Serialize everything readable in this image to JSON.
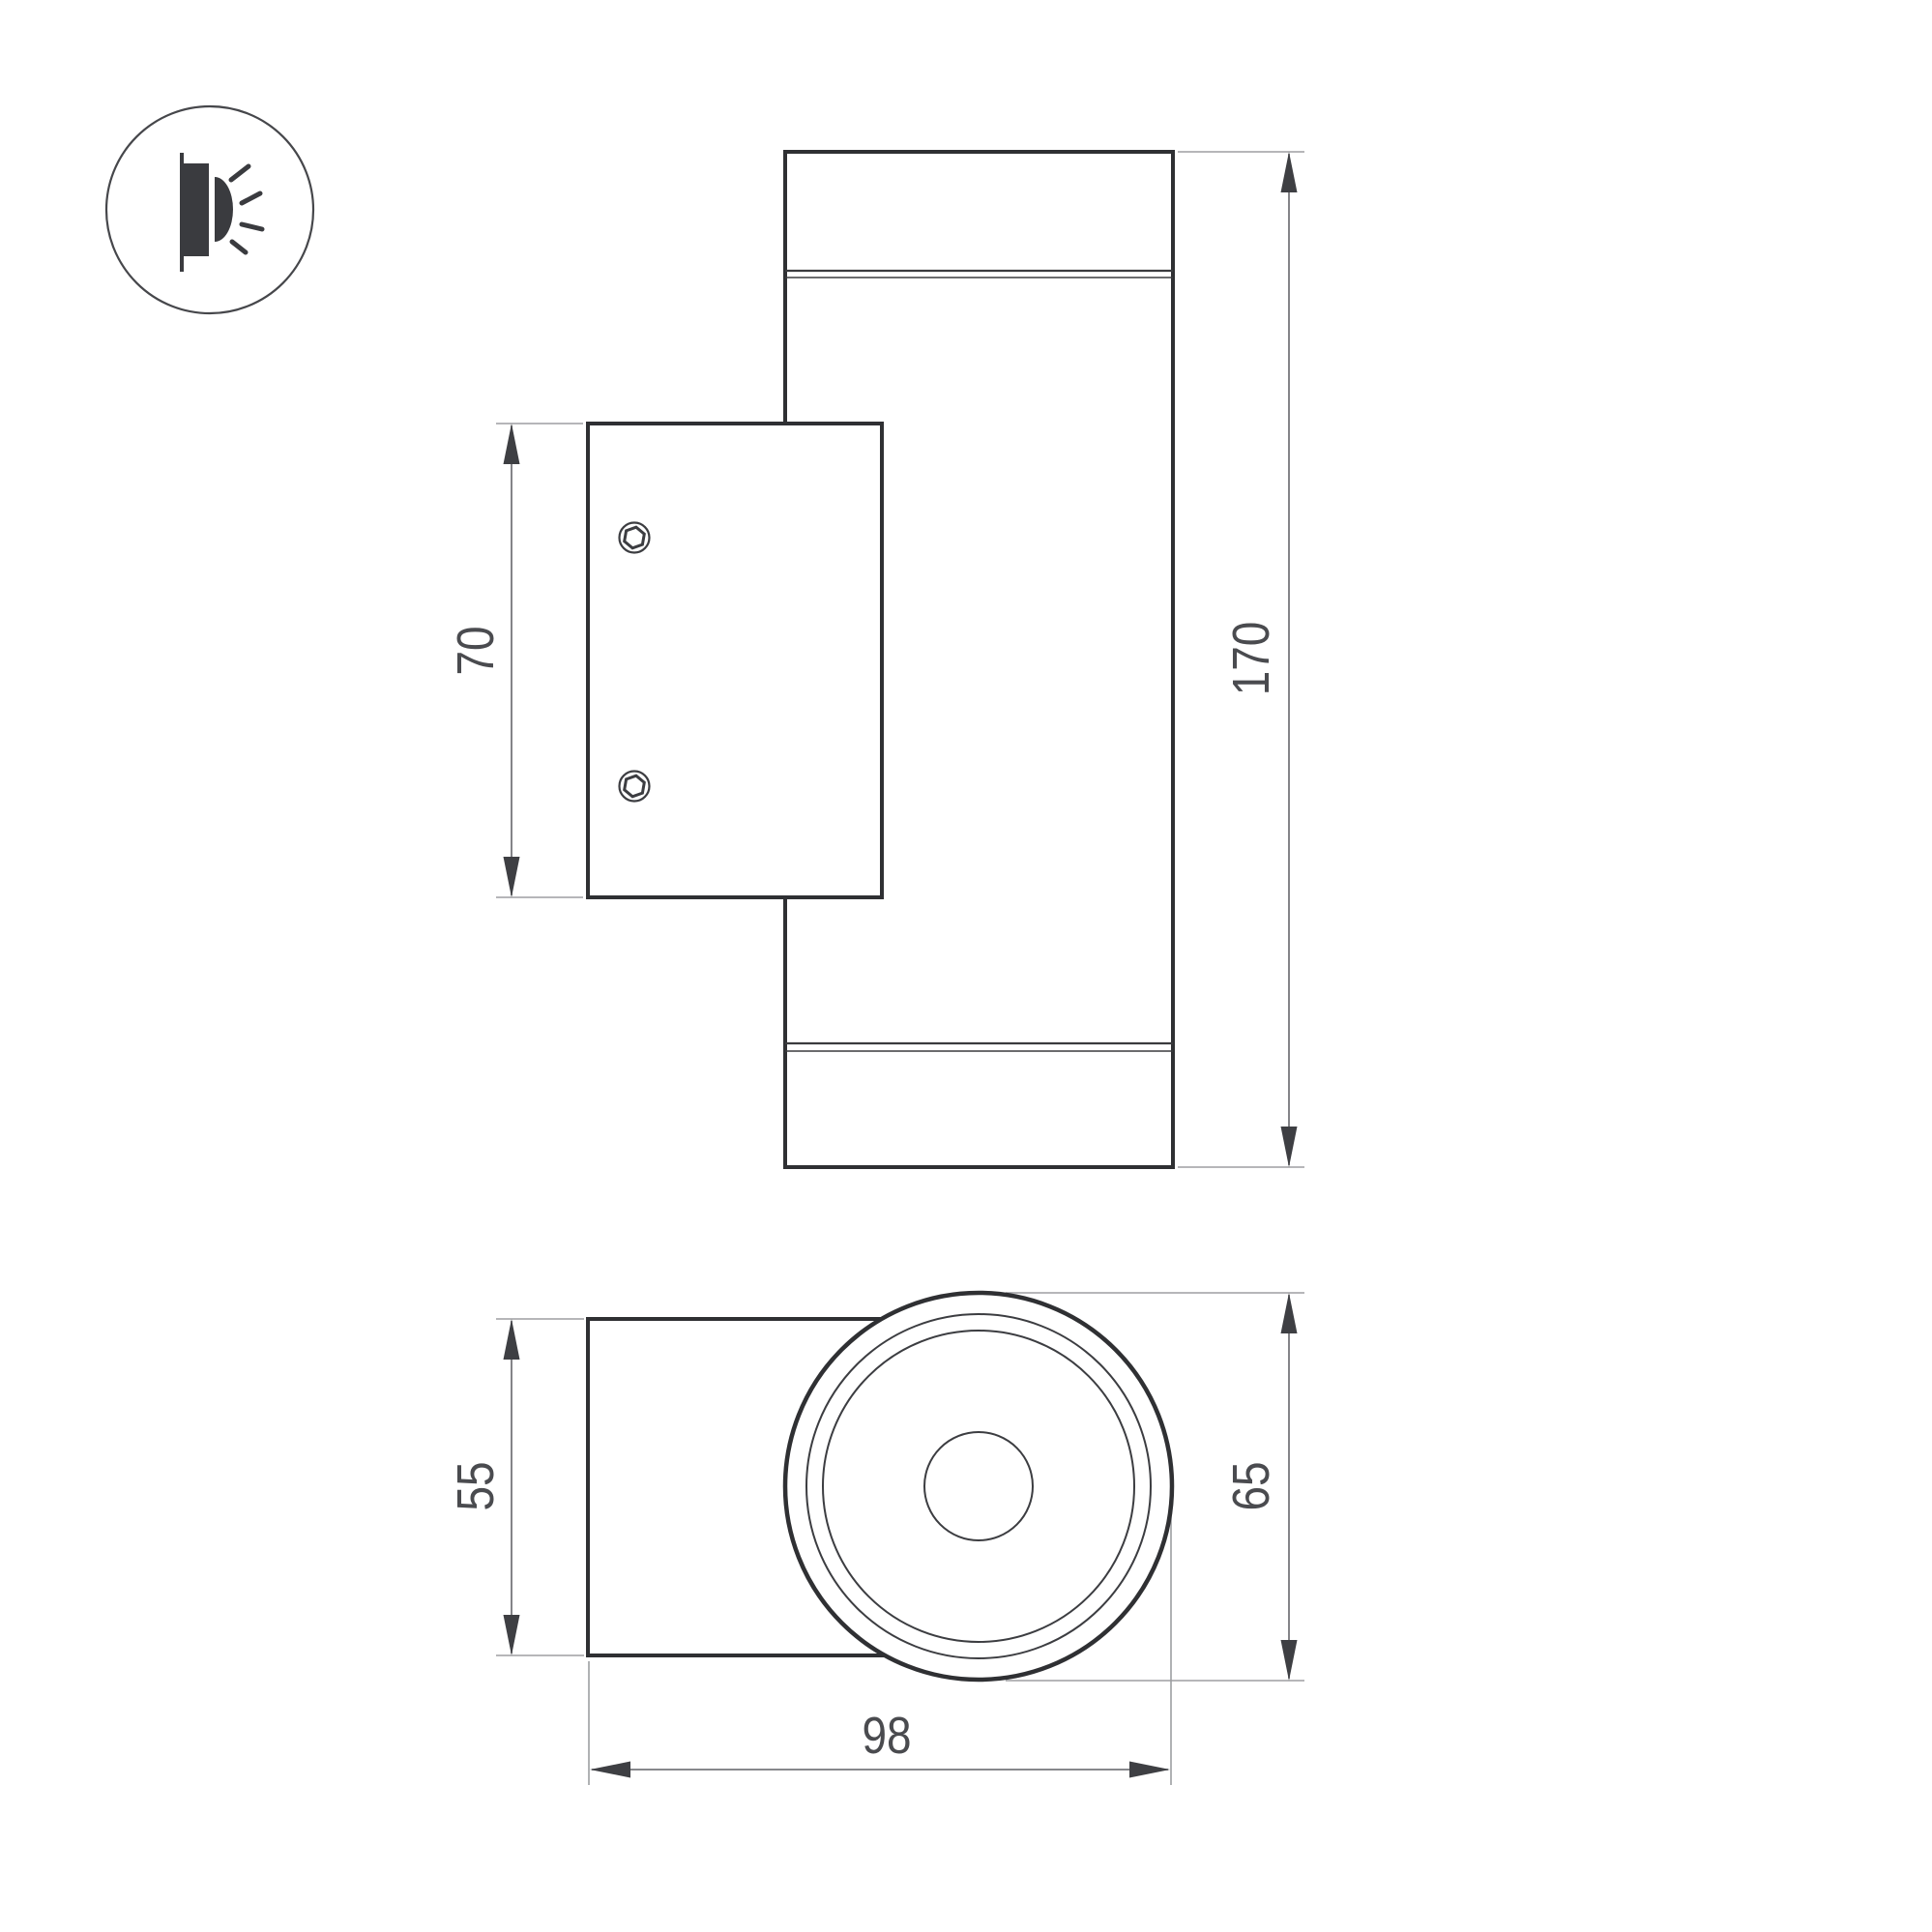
{
  "drawing": {
    "type": "technical-dimension-drawing of wall-mounted cylindrical luminaire, two orthographic views",
    "background": "#ffffff",
    "icon": {
      "name": "wall-lamp-glow-icon",
      "meaning": "wall-mounted light emitting sideways"
    },
    "dimensions": {
      "plate_height": "70",
      "body_height": "170",
      "mount_depth": "55",
      "body_diameter": "65",
      "total_depth": "98"
    },
    "colors": {
      "outline": "#2f3033",
      "thin_line": "#3c3d41",
      "dimension_line": "#76777b",
      "extension_line": "#9d9ea2",
      "arrow": "#3e3f43",
      "text": "#4a4b4f",
      "icon_fill": "#3a3b3f"
    }
  }
}
